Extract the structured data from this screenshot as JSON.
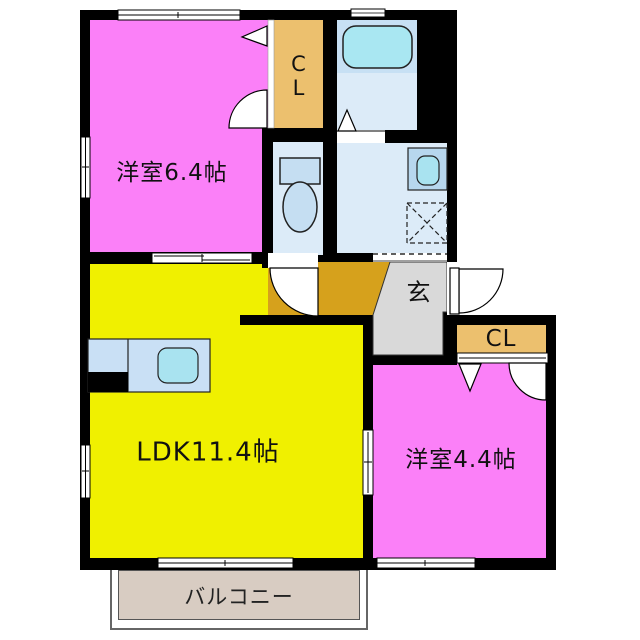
{
  "floorplan": {
    "type": "apartment-floor-plan",
    "rooms": {
      "bedroom_top": {
        "label": "洋室6.4帖",
        "color": "#fb80f8"
      },
      "closet_top": {
        "line1": "C",
        "line2": "L",
        "color": "#ecc06e"
      },
      "bathroom": {
        "color": "#dcebf8",
        "tub_color": "#a9e7f2"
      },
      "toilet": {
        "color": "#dcebf8"
      },
      "washroom": {
        "color": "#dcebf8"
      },
      "hall": {
        "color": "#d6a11c"
      },
      "genkan": {
        "label": "玄",
        "color": "#d9d9d9"
      },
      "ldk": {
        "label": "LDK11.4帖",
        "color": "#f0f000"
      },
      "closet_right": {
        "label": "CL",
        "color": "#ecc06e"
      },
      "bedroom_right": {
        "label": "洋室4.4帖",
        "color": "#fb80f8"
      },
      "balcony": {
        "label": "バルコニー",
        "color": "#d8ccc2"
      }
    },
    "fixtures": [
      "bathtub",
      "washbasin",
      "washing-machine-pan",
      "toilet",
      "kitchen-counter",
      "kitchen-sink",
      "entry-door",
      "room-doors",
      "closet-doors",
      "sliding-doors",
      "windows"
    ],
    "colors": {
      "wall": "#000000",
      "outline": "#222222",
      "fixture_blue": "#c9e0f5",
      "cyan": "#a9e7f2",
      "tub_surround": "#c7e0f4"
    }
  }
}
